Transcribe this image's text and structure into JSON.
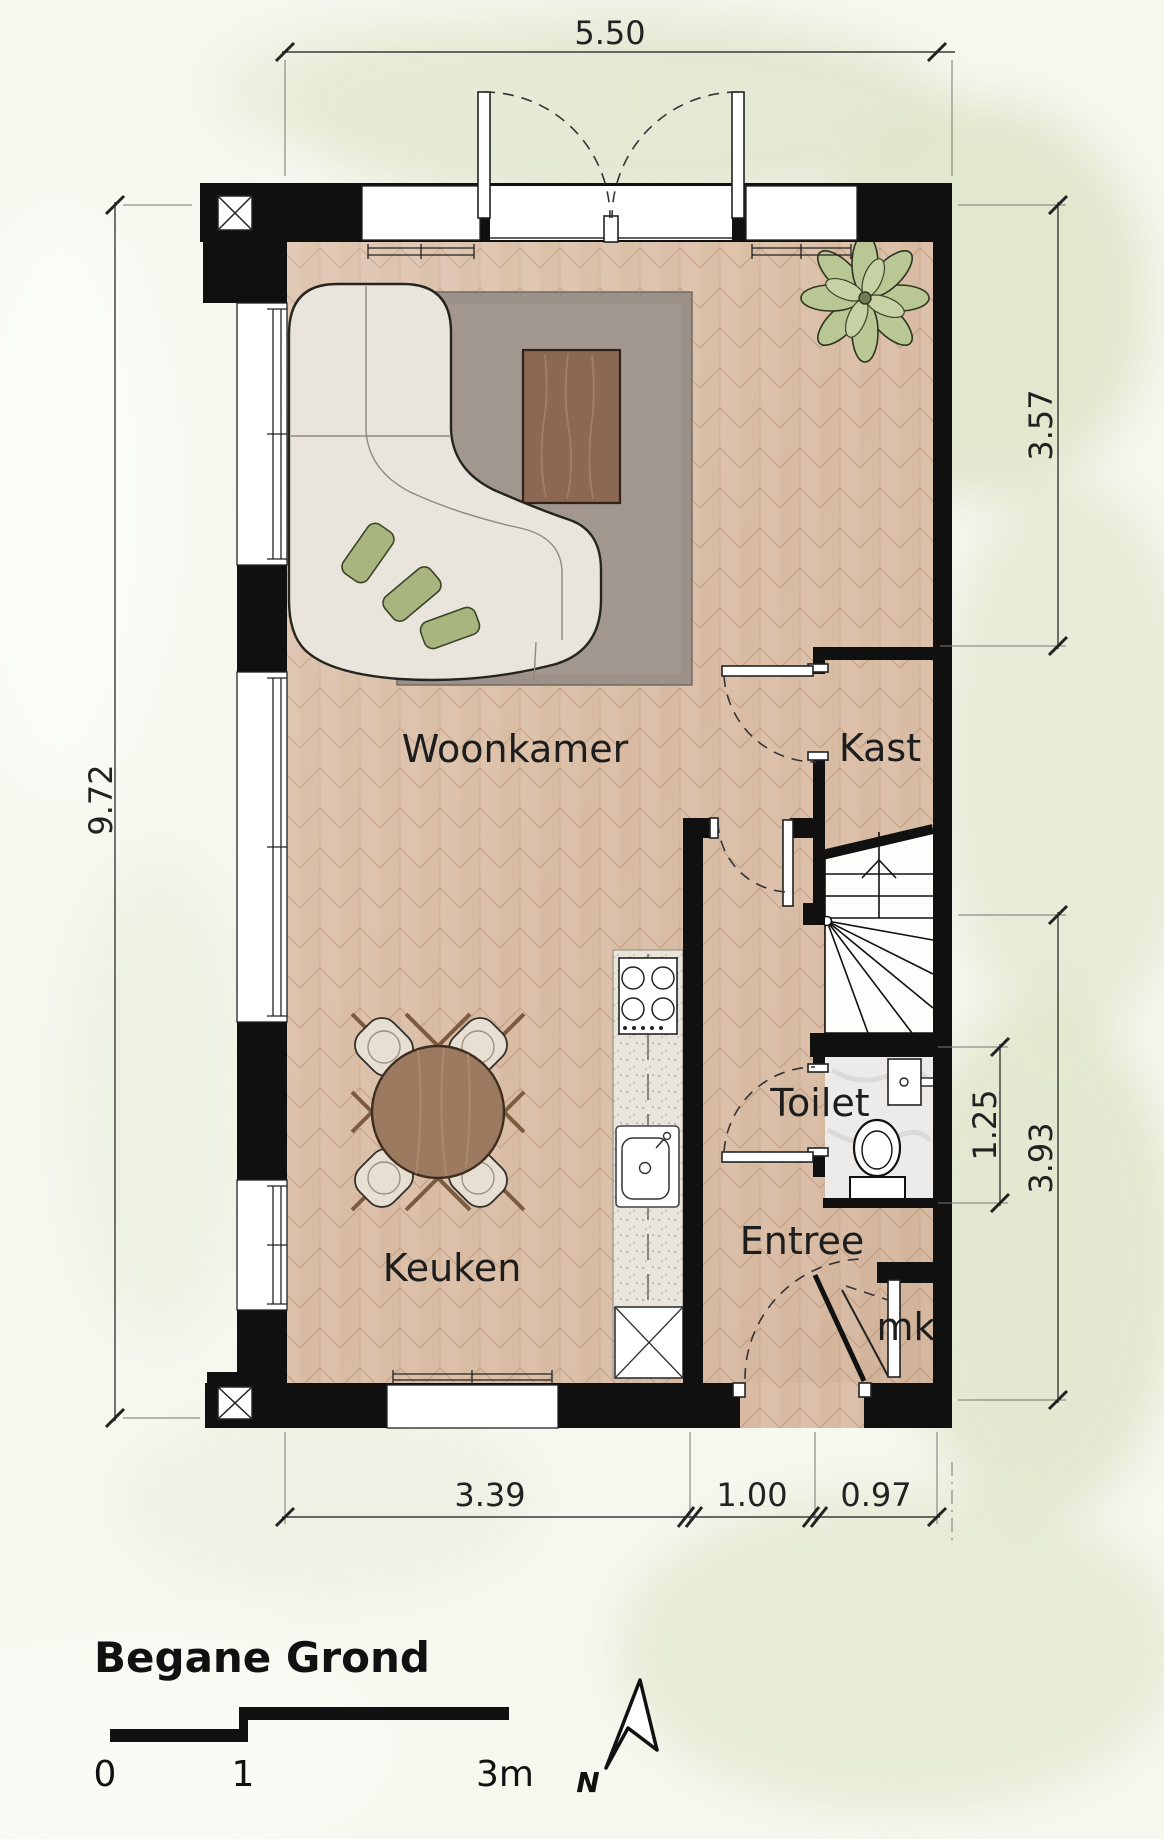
{
  "title_block": {
    "title": "Begane Grond",
    "scale_bar": {
      "zero": "0",
      "one": "1",
      "three": "3m"
    },
    "north_label": "N"
  },
  "rooms": {
    "woonkamer": "Woonkamer",
    "keuken": "Keuken",
    "kast": "Kast",
    "toilet": "Toilet",
    "entree": "Entree",
    "meterkast": "mk"
  },
  "dimensions": {
    "top_width": "5.50",
    "left_height": "9.72",
    "right_upper": "3.57",
    "right_lower": "3.93",
    "toilet_depth": "1.25",
    "bottom_left": "3.39",
    "bottom_center": "1.00",
    "bottom_right": "0.97"
  },
  "colors": {
    "wall": "#101010",
    "floor": "#d9bda5",
    "rug": "#9b9189",
    "marble": "#edebe9",
    "cushion": "#a8b57e",
    "plant": "#b9c795",
    "counter": "#e9e5dc",
    "wood": "#9b7a5f"
  }
}
